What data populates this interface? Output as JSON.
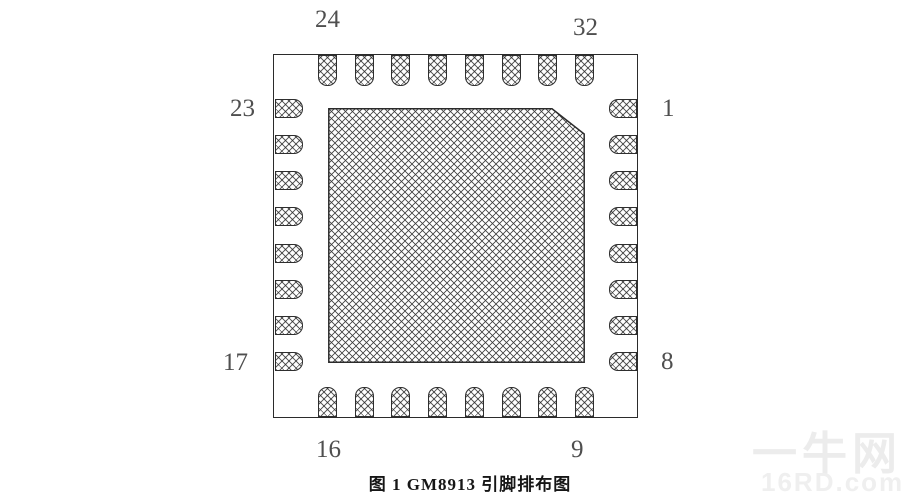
{
  "figure": {
    "chip_name": "GM8913",
    "caption": "图 1 GM8913 引脚排布图",
    "package_type": "QFN-32 pin layout",
    "pins_per_side": 8,
    "pin_labels": {
      "top_left": "24",
      "top_right": "32",
      "left_top": "23",
      "left_bottom": "17",
      "right_top": "1",
      "right_bottom": "8",
      "bottom_left": "16",
      "bottom_right": "9"
    }
  },
  "watermark": {
    "site_name": "一牛网",
    "site_domain": "16RD.com"
  },
  "colors": {
    "line": "#2b2b2b",
    "label": "#4f4f4f",
    "caption": "#161616",
    "watermark": "#ececec",
    "background": "#ffffff"
  }
}
